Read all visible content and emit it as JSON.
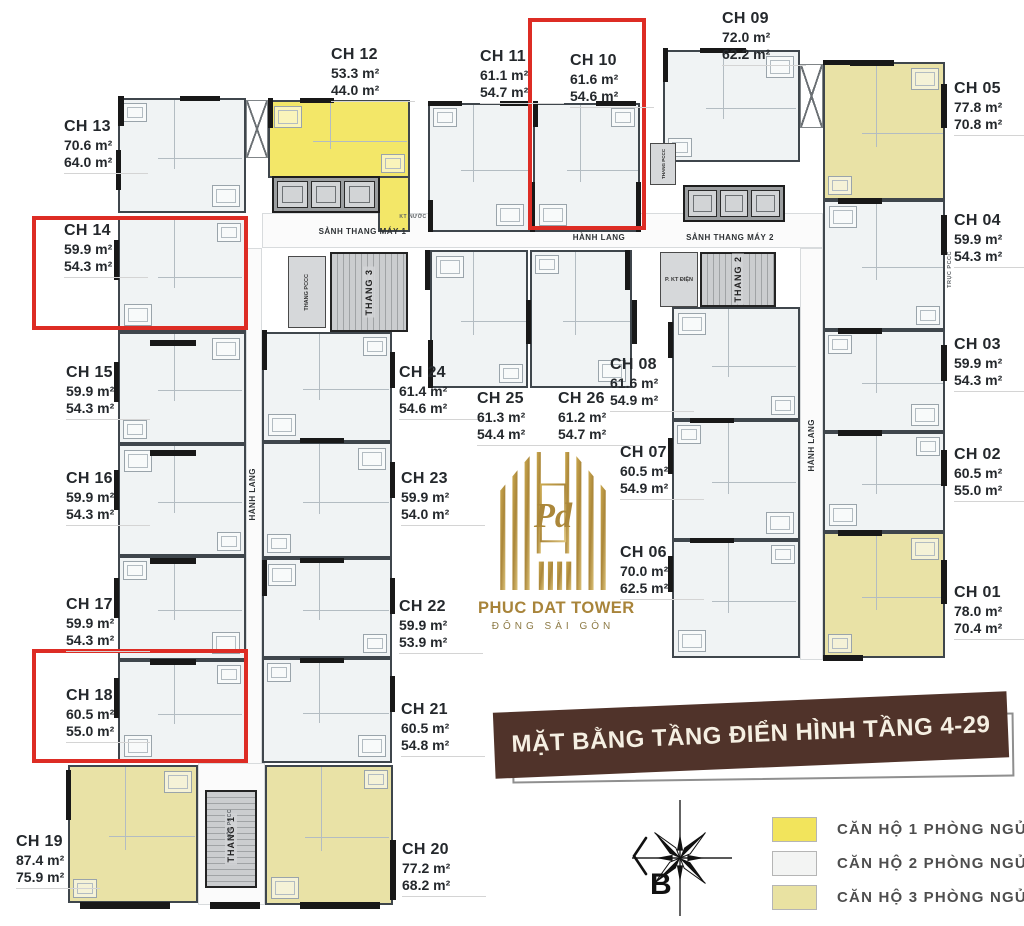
{
  "banner": {
    "title": "MẶT BẰNG TẦNG ĐIỂN HÌNH TẦNG 4-29"
  },
  "logo": {
    "title": "PHUC DAT TOWER",
    "subtitle": "ĐÔNG SÀI GÒN",
    "monogram": "Pd"
  },
  "compass": {
    "label": "B"
  },
  "highlight_color": "#dd2c24",
  "legend": {
    "items": [
      {
        "type": "1pn",
        "label": "CĂN HỘ 1 PHÒNG NGỦ",
        "color": "#f2e45c"
      },
      {
        "type": "2pn",
        "label": "CĂN HỘ 2 PHÒNG NGỦ",
        "color": "#f3f4f3"
      },
      {
        "type": "3pn",
        "label": "CĂN HỘ 3 PHÒNG NGỦ",
        "color": "#e9e2a2"
      }
    ]
  },
  "units": [
    {
      "id": "CH 01",
      "gross": "78.0 m²",
      "net": "70.4 m²",
      "type": "3pn",
      "highlighted": false
    },
    {
      "id": "CH 02",
      "gross": "60.5 m²",
      "net": "55.0 m²",
      "type": "2pn",
      "highlighted": false
    },
    {
      "id": "CH 03",
      "gross": "59.9 m²",
      "net": "54.3 m²",
      "type": "2pn",
      "highlighted": false
    },
    {
      "id": "CH 04",
      "gross": "59.9 m²",
      "net": "54.3 m²",
      "type": "2pn",
      "highlighted": false
    },
    {
      "id": "CH 05",
      "gross": "77.8 m²",
      "net": "70.8 m²",
      "type": "3pn",
      "highlighted": false
    },
    {
      "id": "CH 06",
      "gross": "70.0 m²",
      "net": "62.5 m²",
      "type": "2pn",
      "highlighted": false
    },
    {
      "id": "CH 07",
      "gross": "60.5 m²",
      "net": "54.9 m²",
      "type": "2pn",
      "highlighted": false
    },
    {
      "id": "CH 08",
      "gross": "61.6 m²",
      "net": "54.9 m²",
      "type": "2pn",
      "highlighted": false
    },
    {
      "id": "CH 09",
      "gross": "72.0 m²",
      "net": "62.2 m²",
      "type": "2pn",
      "highlighted": false
    },
    {
      "id": "CH 10",
      "gross": "61.6 m²",
      "net": "54.6 m²",
      "type": "2pn",
      "highlighted": true
    },
    {
      "id": "CH 11",
      "gross": "61.1 m²",
      "net": "54.7 m²",
      "type": "2pn",
      "highlighted": false
    },
    {
      "id": "CH 12",
      "gross": "53.3 m²",
      "net": "44.0 m²",
      "type": "1pn",
      "highlighted": false
    },
    {
      "id": "CH 13",
      "gross": "70.6 m²",
      "net": "64.0 m²",
      "type": "2pn",
      "highlighted": false
    },
    {
      "id": "CH 14",
      "gross": "59.9 m²",
      "net": "54.3 m²",
      "type": "2pn",
      "highlighted": true
    },
    {
      "id": "CH 15",
      "gross": "59.9 m²",
      "net": "54.3 m²",
      "type": "2pn",
      "highlighted": false
    },
    {
      "id": "CH 16",
      "gross": "59.9 m²",
      "net": "54.3 m²",
      "type": "2pn",
      "highlighted": false
    },
    {
      "id": "CH 17",
      "gross": "59.9 m²",
      "net": "54.3 m²",
      "type": "2pn",
      "highlighted": false
    },
    {
      "id": "CH 18",
      "gross": "60.5 m²",
      "net": "55.0 m²",
      "type": "2pn",
      "highlighted": true
    },
    {
      "id": "CH 19",
      "gross": "87.4 m²",
      "net": "75.9 m²",
      "type": "3pn",
      "highlighted": false
    },
    {
      "id": "CH 20",
      "gross": "77.2 m²",
      "net": "68.2 m²",
      "type": "3pn",
      "highlighted": false
    },
    {
      "id": "CH 21",
      "gross": "60.5 m²",
      "net": "54.8 m²",
      "type": "2pn",
      "highlighted": false
    },
    {
      "id": "CH 22",
      "gross": "59.9 m²",
      "net": "53.9 m²",
      "type": "2pn",
      "highlighted": false
    },
    {
      "id": "CH 23",
      "gross": "59.9 m²",
      "net": "54.0 m²",
      "type": "2pn",
      "highlighted": false
    },
    {
      "id": "CH 24",
      "gross": "61.4 m²",
      "net": "54.6 m²",
      "type": "2pn",
      "highlighted": false
    },
    {
      "id": "CH 25",
      "gross": "61.3 m²",
      "net": "54.4 m²",
      "type": "2pn",
      "highlighted": false
    },
    {
      "id": "CH 26",
      "gross": "61.2 m²",
      "net": "54.7 m²",
      "type": "2pn",
      "highlighted": false
    }
  ],
  "zones": {
    "sanh_thang_may_1": "SẢNH THANG MÁY 1",
    "hanh_lang_top": "HÀNH LANG",
    "sanh_thang_may_2": "SẢNH THANG MÁY 2",
    "hanh_lang_left": "HÀNH LANG",
    "hanh_lang_right": "HÀNH LANG",
    "thang_1": "THANG 1",
    "thang_2": "THANG 2",
    "thang_3": "THANG 3",
    "thang_pccc_1": "THANG PCCC",
    "thang_pccc_2": "THANG PCCC",
    "p_kt_dien": "P. KT ĐIỆN",
    "truc_pccc": "TRỤC PCCC",
    "kt_nuoc": "KT NƯỚC",
    "hop_pccc": "HỘP PCCC"
  }
}
